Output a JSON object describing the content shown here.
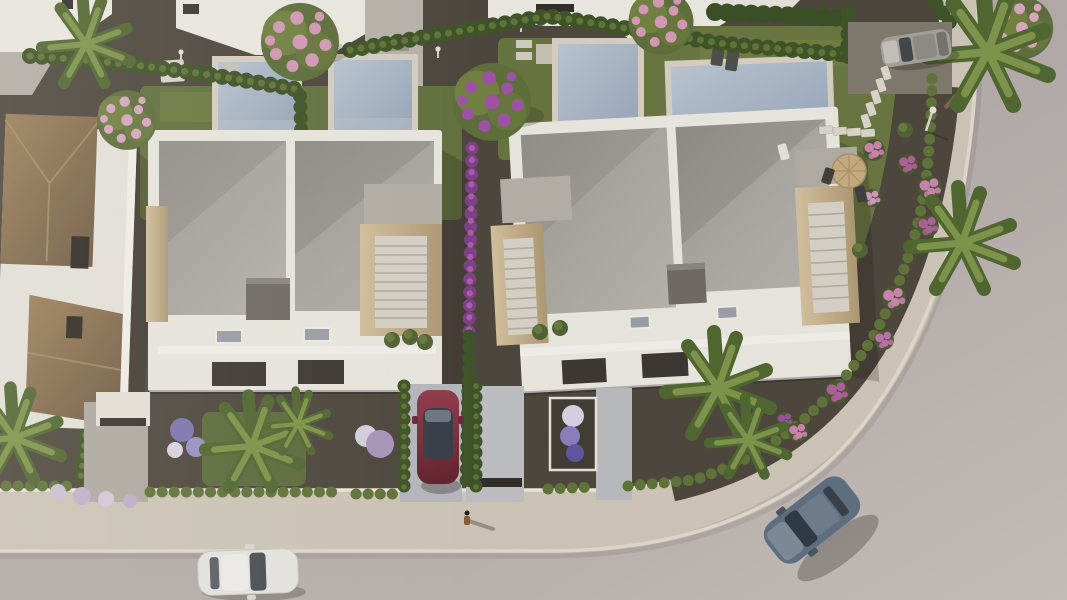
{
  "scene": {
    "title": "aerial-render-residential-development",
    "description": "Bird's-eye 3D architectural render: two white duplex villas with private pools and gardens, an older tiled-roof house, a curved street with sidewalk, parked and moving cars, palms and flowering shrubs",
    "lighting": "low sun from the left, long shadows cast to the right",
    "counts": {
      "duplex_villas": 2,
      "pools": 4,
      "cars": 4,
      "pedestrians": 1,
      "palm_clusters": 7,
      "flowering_trees": 4
    }
  },
  "colors": {
    "road": "#b2aaa8",
    "road_light": "#c7bfbc",
    "sidewalk": "#cfc8ba",
    "curb": "#e3dccd",
    "gravel": "#4b443b",
    "grass": "#61703c",
    "grass_light": "#7a8749",
    "hedge": "#3c5124",
    "shrub": "#5e7236",
    "pool_water": "#a9b6c7",
    "pool_coping": "#d9d2c4",
    "building_white": "#edeae4",
    "roof_gray": "#a9a6a1",
    "stone_cladding": "#c9b28b",
    "tile_roof": "#8a6e4e",
    "chimney": "#6e6963",
    "car_red": "#842f3c",
    "car_blue": "#5e6e81",
    "car_white": "#e9e8e5",
    "car_silver": "#a5a29b",
    "flower_pink": "#cd84b2",
    "flower_purple": "#9a4fa5",
    "flower_blue": "#7d74b5",
    "parasol_tan": "#c7ae7f",
    "palm_green": "#50682f",
    "shadow": "rgba(25,20,14,0.25)"
  },
  "objects": {
    "villa_a": "white duplex villa with two pools",
    "villa_b": "white duplex villa with pool and palm garden",
    "tiled_house": "older house with brown tiled hip roofs",
    "pools": [
      "pool-1",
      "pool-2",
      "pool-3",
      "pool-4"
    ],
    "cars": [
      "red-car-parked-driveway",
      "white-car-on-road",
      "blue-car-on-road",
      "silver-suv-parked"
    ],
    "pedestrian": "person walking on sidewalk with long shadow"
  }
}
